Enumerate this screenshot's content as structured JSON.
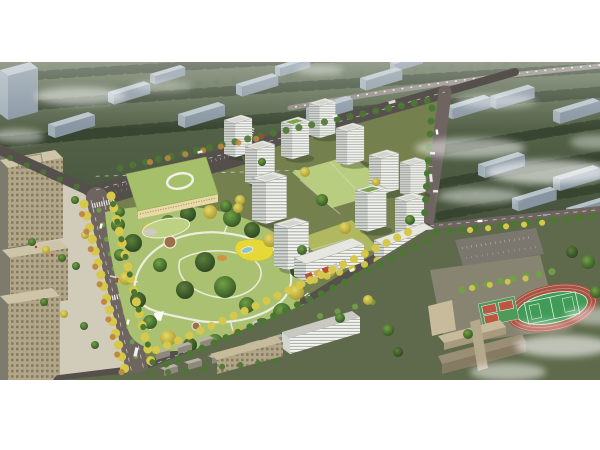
{
  "scene": {
    "title": "Aerial architectural rendering of a residential development with central park",
    "type": "architectural-visualization",
    "canvas": {
      "width": 600,
      "height": 450,
      "image_top": 62,
      "image_bottom": 380
    },
    "palette": {
      "bg": "#ffffff",
      "distantGroundLight": "#5c6a4e",
      "distantGroundDark": "#42503b",
      "distantTree": "#36432e",
      "distantTreeLight": "#53644a",
      "distantSlabRoof": "#b7c3cb",
      "distantSlabFace": "#8795a1",
      "distantSlabSide": "#9fadb6",
      "roadDark": "#55504c",
      "roadMain": "#6e6561",
      "roadLight": "#8e8882",
      "parcelGround": "#75804f",
      "parkLawn": "#a9c170",
      "parkLawnLight": "#bdd183",
      "pathWhite": "#efefe6",
      "playYellow": "#e6d838",
      "plazaBrown": "#9c7049",
      "waterBlue": "#93c2cd",
      "treeGreen": "#4c7733",
      "treeGreenLight": "#72a145",
      "treeYellow": "#d5c84b",
      "treeOrange": "#c08a3e",
      "towerFaceLight": "#f3f3ee",
      "towerFaceShade": "#d4d6d0",
      "towerStripe": "#a9aeab",
      "towerStripeDark": "#8f9693",
      "towerRoof": "#e6e7e1",
      "towerRoofGreen": "#7ba34c",
      "retailAccent": "#b5503d",
      "kinderRoof": "#a5bf6a",
      "kinderWall": "#e9d9a5",
      "officeBeige": "#cec5a9",
      "officeFace": "#b2a688",
      "schoolBeige": "#c7bb9c",
      "trackRed": "#a85342",
      "pitchGreen": "#419b58",
      "pitchGreenLight": "#55ac64",
      "courtRed": "#bb5743",
      "courtGreen": "#4e9a59",
      "pavedPlaza": "#d6d0bf",
      "bottomGround": "#5e6a4b",
      "cloudWhite": "#ffffff"
    },
    "elements": {
      "context": "rows of existing apartment slabs among dense dark trees, partly covered by drifting fog",
      "development": "11 white high-rise residential towers around landscaped courtyards",
      "retail": "2 mid-rise slabs with ground-floor shops along the south edge",
      "kindergarten": "U-shaped building with light-green roof and white oval rooftop ring",
      "park": "central park with looping white paths, yellow playground, round plazas, small pond and dense mixed trees",
      "boulevard": "yellow-tree-lined boulevard with median along the west edge of the park",
      "offices": "beige office blocks and paved plaza on the far west",
      "school": "campus at bottom right with beige slab buildings, parking lot, basketball courts and red running track around a green pitch",
      "clouds": "white fog streaks at top left, centre right and bottom right"
    }
  }
}
